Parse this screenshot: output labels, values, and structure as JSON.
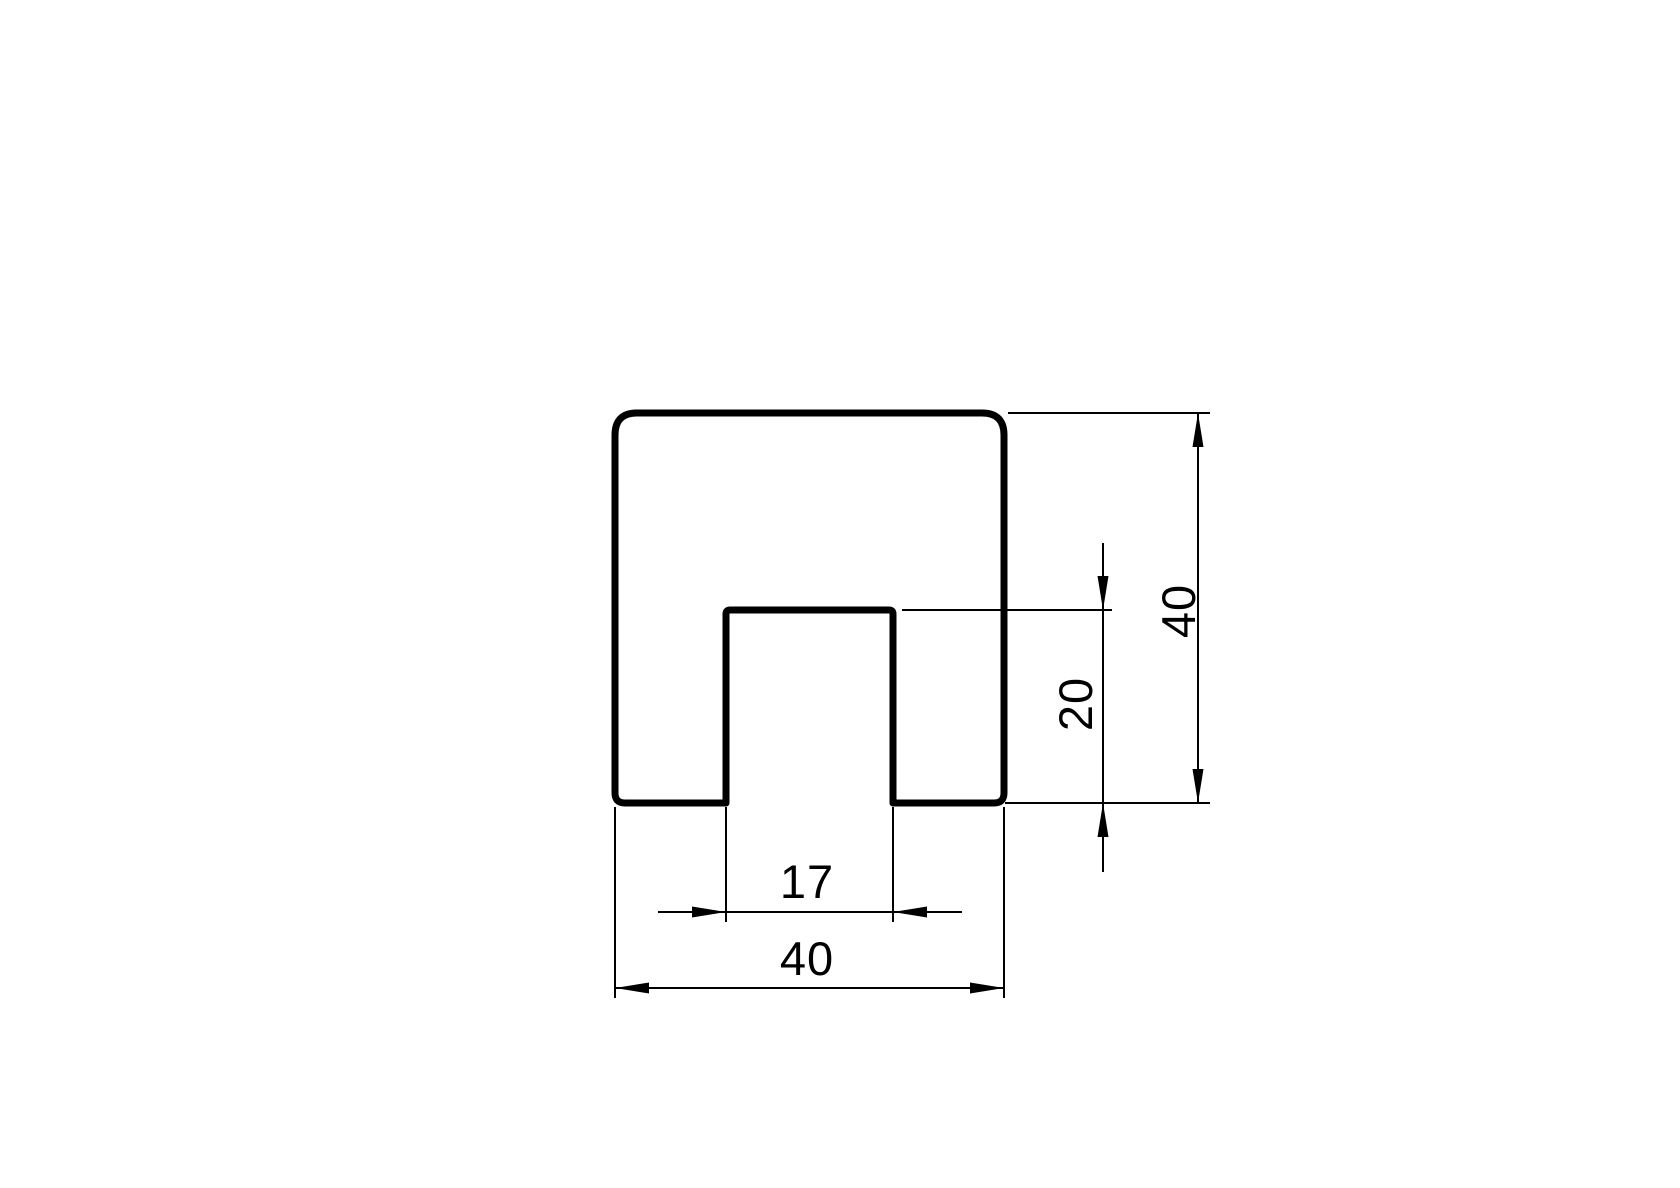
{
  "drawing": {
    "colors": {
      "line": "#000000",
      "background": "#ffffff"
    },
    "dimensions": {
      "overall_width": "40",
      "overall_height": "40",
      "slot_width": "17",
      "slot_depth": "20"
    }
  }
}
